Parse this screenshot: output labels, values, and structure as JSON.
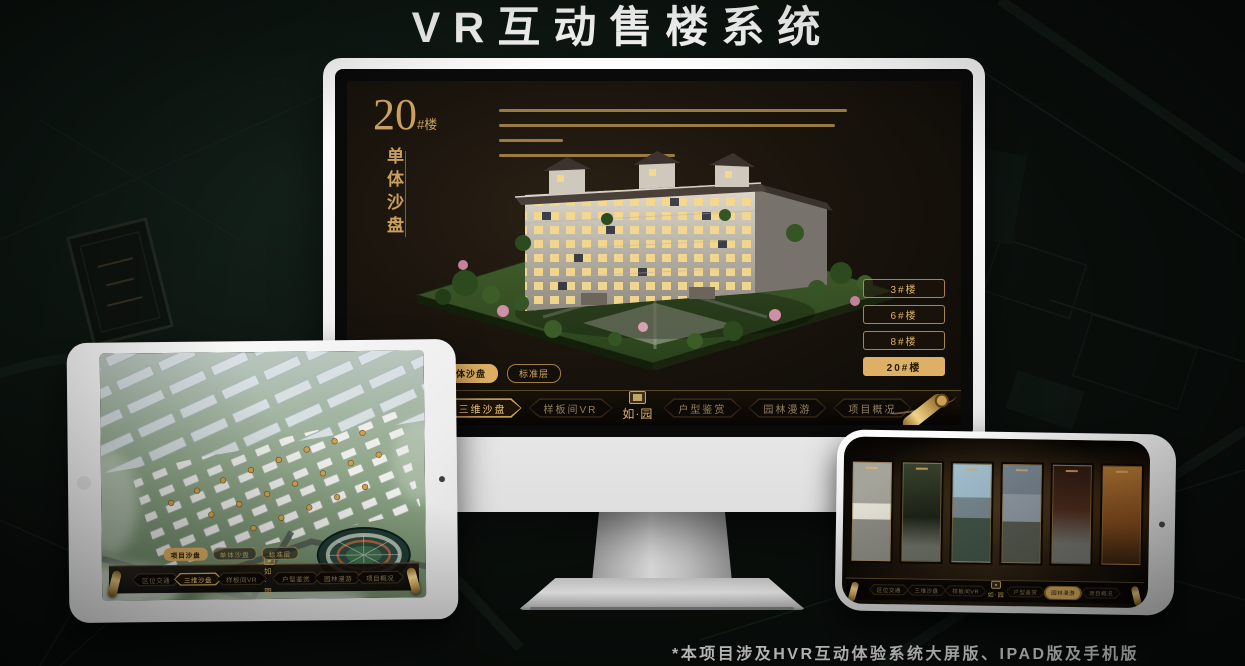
{
  "page": {
    "title": "VR互动售楼系统",
    "footnote": "*本项目涉及HVR互动体验系统大屏版、IPAD版及手机版"
  },
  "brand": {
    "logo_text": "如·园",
    "logo_seal_icon": "seal-icon"
  },
  "colors": {
    "gold_accent": "#D9AE5F",
    "gold_active_fill": "#DDB065",
    "gold_text": "#C9A05E",
    "screen_dark": "#1A140D"
  },
  "desktop": {
    "title": {
      "number": "20",
      "suffix": "#楼",
      "subtitle": "单体沙盘"
    },
    "floor_buttons": [
      {
        "label": "3#楼",
        "active": false
      },
      {
        "label": "6#楼",
        "active": false
      },
      {
        "label": "8#楼",
        "active": false
      },
      {
        "label": "20#楼",
        "active": true
      }
    ],
    "view_tabs": [
      {
        "label": "项目沙盘",
        "active": false
      },
      {
        "label": "单体沙盘",
        "active": true
      },
      {
        "label": "标准层",
        "active": false
      }
    ],
    "nav_items": [
      {
        "label": "区位交通",
        "active": false
      },
      {
        "label": "三维沙盘",
        "active": true
      },
      {
        "label": "样板间VR",
        "active": false
      },
      {
        "label": "户型鉴赏",
        "active": false
      },
      {
        "label": "园林漫游",
        "active": false
      },
      {
        "label": "项目概况",
        "active": false
      }
    ],
    "scroll_icon": "scroll-icon"
  },
  "tablet": {
    "view_tabs": [
      {
        "label": "项目沙盘",
        "active": true
      },
      {
        "label": "单体沙盘",
        "active": false
      },
      {
        "label": "标准层",
        "active": false
      }
    ],
    "nav_items": [
      {
        "label": "区位交通",
        "active": false
      },
      {
        "label": "三维沙盘",
        "active": true
      },
      {
        "label": "样板间VR",
        "active": false
      },
      {
        "label": "户型鉴赏",
        "active": false
      },
      {
        "label": "园林漫游",
        "active": false
      },
      {
        "label": "项目概况",
        "active": false
      }
    ]
  },
  "phone": {
    "nav_items": [
      {
        "label": "区位交通",
        "active": false
      },
      {
        "label": "三维沙盘",
        "active": false
      },
      {
        "label": "样板间VR",
        "active": false
      },
      {
        "label": "户型鉴赏",
        "active": false
      },
      {
        "label": "园林漫游",
        "active": true
      },
      {
        "label": "项目概况",
        "active": false
      }
    ]
  }
}
